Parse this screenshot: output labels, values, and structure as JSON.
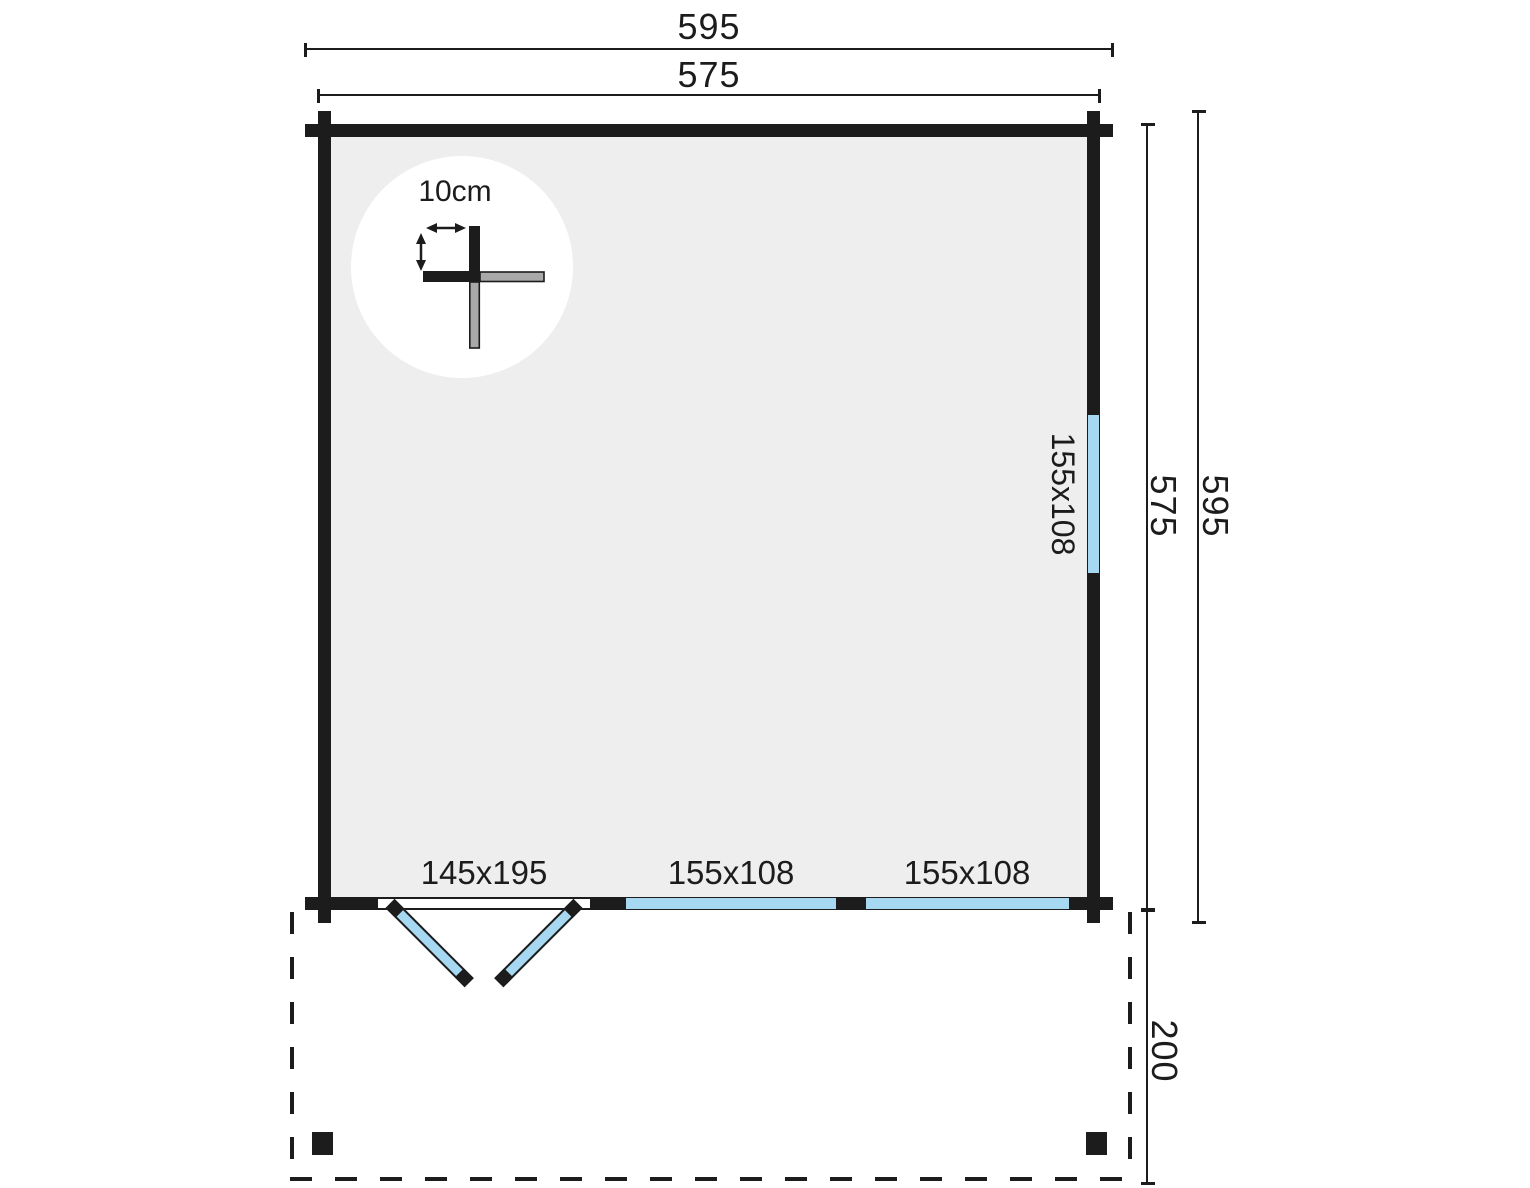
{
  "dimensions": {
    "width_overall": "595",
    "width_wall": "575",
    "depth_wall": "575",
    "depth_overall": "595",
    "terrace_depth": "200"
  },
  "detail": {
    "wall_thickness": "10cm"
  },
  "openings": {
    "door": {
      "label": "145x195"
    },
    "window_right_wall": {
      "label": "155x108"
    },
    "window_bottom_left": {
      "label": "155x108"
    },
    "window_bottom_right": {
      "label": "155x108"
    }
  },
  "colors": {
    "wall": "#1c1c1c",
    "floor": "#eeeeee",
    "glass": "#a6d8f1",
    "log_end_gray": "#a9a9a9",
    "background": "#ffffff"
  }
}
